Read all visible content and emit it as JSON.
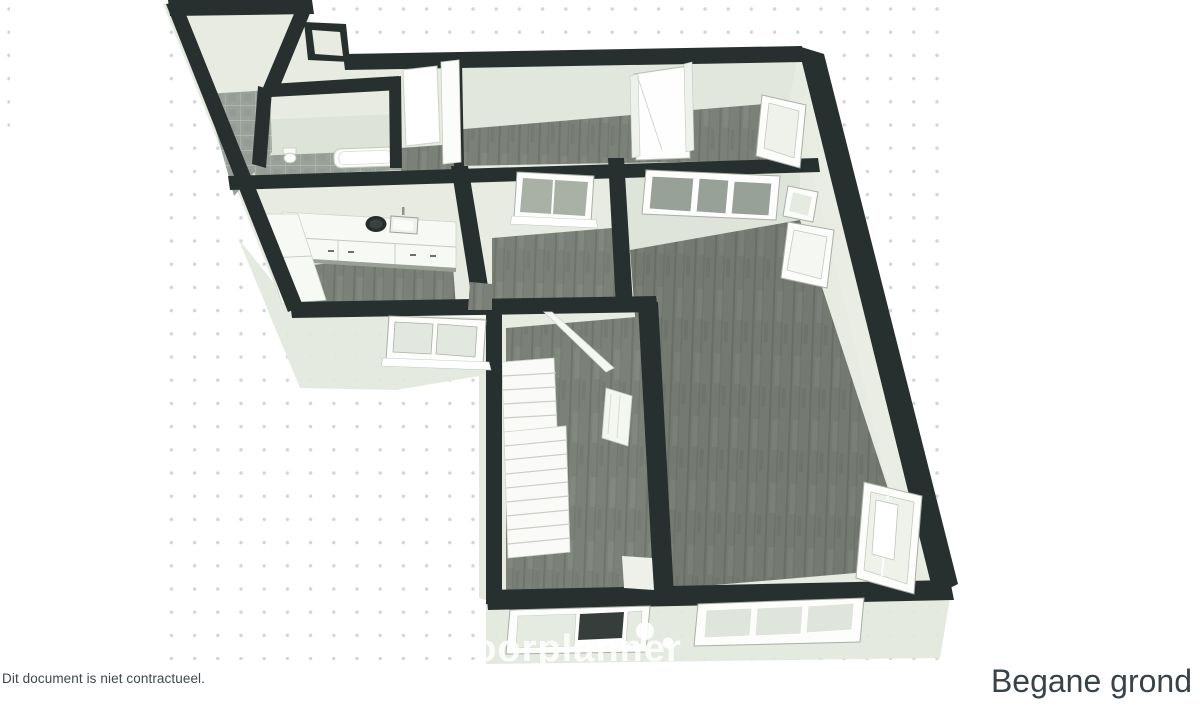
{
  "document": {
    "disclaimer": "Dit document is niet contractueel.",
    "floor_label": "Begane grond",
    "watermark": "floorplanner"
  },
  "render": {
    "view": "3d-floorplan-perspective",
    "background": {
      "dot_color": "#d2d4d7",
      "dot_spacing_px": 23
    },
    "colors": {
      "wall_cut": "#28302f",
      "wall_face": "#e7ebe2",
      "exterior_skirt": "#e3e8de",
      "floor_wood": "#7b8179",
      "floor_tile": "#9aa19a",
      "fixture_white": "#fafcf9",
      "window_pane": "#97a198",
      "text": "#3e474c"
    },
    "fixtures": [
      "kitchen-counter",
      "cooktop",
      "sink",
      "bathtub",
      "toilet",
      "staircase",
      "railing",
      "radiator",
      "windows",
      "doors"
    ]
  }
}
